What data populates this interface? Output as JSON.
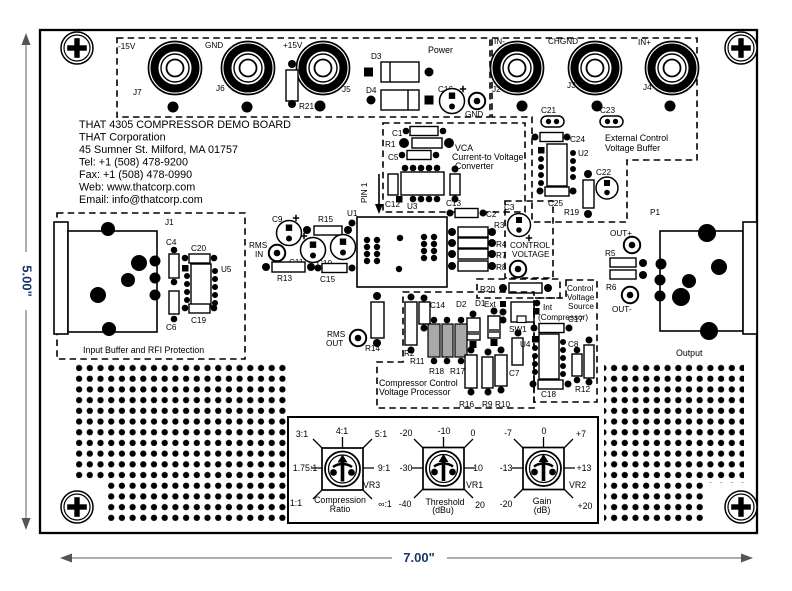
{
  "title_block": [
    "THAT 4305 COMPRESSOR DEMO BOARD",
    "THAT Corporation",
    "45 Sumner St. Milford, MA 01757",
    "Tel: +1 (508) 478-9200",
    "Fax: +1 (508) 478-0990",
    "Web: www.thatcorp.com",
    "Email: info@thatcorp.com"
  ],
  "dimensions": {
    "height": "5.00\"",
    "width": "7.00\""
  },
  "sections": {
    "power": {
      "label": "Power",
      "j7": "J7",
      "j7v": "-15V",
      "j6": "J6",
      "j6v": "GND",
      "j5": "J5",
      "j5v": "+15V",
      "r21": "R21",
      "d3": "D3",
      "d4": "D4",
      "c16": "C16",
      "gnd": "GND"
    },
    "inputs": {
      "j2": "J2",
      "j2v": "IN-",
      "j3": "J3",
      "j3v": "CHGND",
      "j4": "J4",
      "j4v": "IN+"
    },
    "ecvb": {
      "l1": "External Control",
      "l2": "Voltage Buffer",
      "c21": "C21",
      "c23": "C23",
      "c24": "C24",
      "u2": "U2",
      "c25": "C25",
      "r19": "R19",
      "c22": "C22"
    },
    "vca": {
      "l1": "VCA",
      "l2": "Current-to Voltage",
      "l3": "Converter",
      "c1": "C1",
      "r1": "R1",
      "c5": "C5",
      "c12": "C12",
      "u3": "U3",
      "c13": "C13"
    },
    "core": {
      "pin1": "PIN 1",
      "u1": "U1",
      "c9": "C9",
      "r15": "R15",
      "rms_in_l1": "RMS",
      "rms_in_l2": "IN",
      "c11": "C11",
      "c10": "C10",
      "r13": "R13",
      "c15": "C15",
      "rms_out_l1": "RMS",
      "rms_out_l2": "OUT",
      "r14": "R14",
      "c2": "C2",
      "r3": "R3",
      "c3": "C3",
      "r4": "R4",
      "r7": "R7",
      "r8": "R8",
      "cv_l1": "CONTROL",
      "cv_l2": "VOLTAGE",
      "r20": "R20"
    },
    "cvs": {
      "l1": "Control",
      "l2": "Voltage",
      "l3": "Source",
      "l4": "(Compressor)",
      "ext": "Ext",
      "int": "Int",
      "sw1": "SW1",
      "d1": "D1",
      "d2": "D2",
      "c7": "C7",
      "c17": "C17",
      "u4": "U4",
      "c8": "C8",
      "c18": "C18",
      "r12": "R12"
    },
    "ccvp": {
      "l1": "Compressor Control",
      "l2": "Voltage Processor",
      "r2": "R2",
      "c14": "C14",
      "r11": "R11",
      "r18": "R18",
      "r17": "R17",
      "r16": "R16",
      "r9": "R9",
      "r10": "R10"
    },
    "input_buffer": {
      "label": "Input Buffer and RFI Protection",
      "j1": "J1",
      "c4": "C4",
      "c20": "C20",
      "u5": "U5",
      "c6": "C6",
      "c19": "C19"
    },
    "output": {
      "label": "Output",
      "p1": "P1",
      "outp": "OUT+",
      "r5": "R5",
      "r6": "R6",
      "outm": "OUT-"
    }
  },
  "controls": {
    "ratio": {
      "name": "VR3",
      "cap1": "Compression",
      "cap2": "Ratio",
      "tl": "3:1",
      "t": "4:1",
      "tr": "5:1",
      "l": "1.75:1",
      "r": "9:1",
      "bl": "1:1",
      "br": "∞:1"
    },
    "threshold": {
      "name": "VR1",
      "cap1": "Threshold",
      "cap2": "(dBu)",
      "tl": "-20",
      "t": "-10",
      "tr": "0",
      "l": "-30",
      "r": "10",
      "bl": "-40",
      "br": "20"
    },
    "gain": {
      "name": "VR2",
      "cap1": "Gain",
      "cap2": "(dB)",
      "tl": "-7",
      "t": "0",
      "tr": "+7",
      "l": "-13",
      "r": "+13",
      "bl": "-20",
      "br": "+20"
    }
  },
  "colors": {
    "silkscreen": "#000000",
    "dimension_text": "#17366e",
    "resistor_fill_gray": "#a8a8a8"
  }
}
